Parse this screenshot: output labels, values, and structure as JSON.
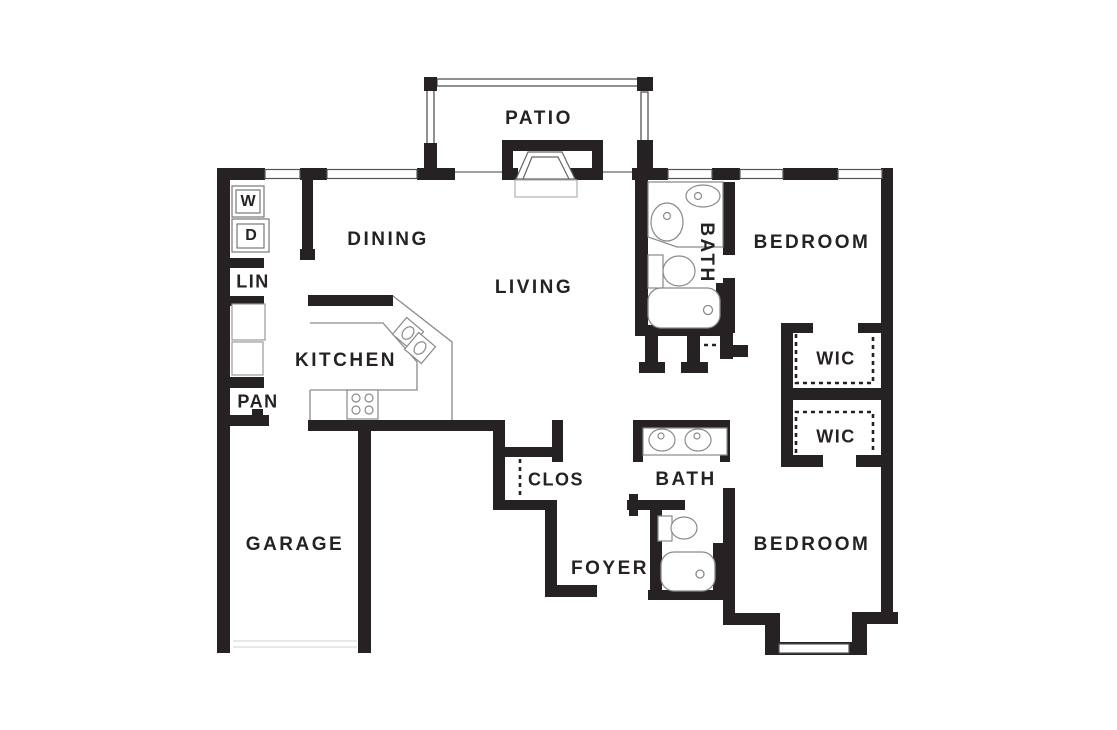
{
  "plan_title": "2 bedroom 2 bath apartment floor plan",
  "colors": {
    "wall": "#262223",
    "fixture_line": "#777777",
    "light_line": "#aaaaaa",
    "background": "#ffffff"
  },
  "rooms": {
    "patio": "PATIO",
    "dining": "DINING",
    "living": "LIVING",
    "kitchen": "KITCHEN",
    "garage": "GARAGE",
    "foyer": "FOYER",
    "closet": "CLOS",
    "bath_upper": "BATH",
    "bath_lower": "BATH",
    "bedroom_upper": "BEDROOM",
    "bedroom_lower": "BEDROOM",
    "wic_upper": "WIC",
    "wic_lower": "WIC",
    "linen": "LIN",
    "pantry": "PAN",
    "washer": "W",
    "dryer": "D"
  }
}
